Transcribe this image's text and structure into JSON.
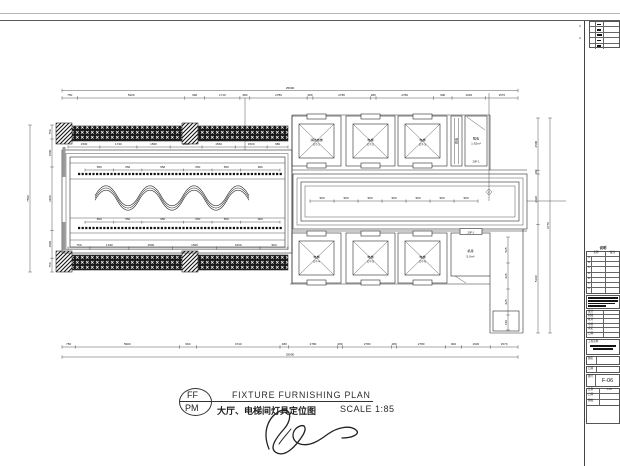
{
  "drawing": {
    "title": "FIXTURE FURNISHING PLAN",
    "subtitle_cn": "大厅、电梯间灯具定位图",
    "scale": "SCALE 1:85",
    "stamp_top": "FF",
    "stamp_bottom": "PM"
  },
  "dims": {
    "overall_top": "25690",
    "overall_bottom": "25690",
    "overall_left": "7560",
    "overall_right": "9770",
    "top": [
      "750",
      "5200",
      "960",
      "1710",
      "480",
      "2780",
      "280",
      "2780",
      "280",
      "2780",
      "900",
      "1630",
      "1570"
    ],
    "bottom": [
      "750",
      "5900",
      "960",
      "4740",
      "480",
      "2780",
      "280",
      "2780",
      "280",
      "2780",
      "900",
      "1630",
      "1570"
    ],
    "left": [
      "750",
      "1500",
      "3400",
      "1500",
      "750"
    ],
    "right": [
      "2500",
      "180",
      "2420",
      "5190"
    ],
    "right_inner": [
      "525",
      "625",
      "625",
      "150"
    ],
    "hall_band": [
      "1500",
      "1740",
      "1560",
      "1500",
      "1560",
      "1500",
      "980"
    ],
    "hall_strip_top": [
      "650",
      "650",
      "950",
      "650",
      "650",
      "900"
    ],
    "hall_strip_bottom": [
      "650",
      "650",
      "950",
      "650",
      "650",
      "900"
    ],
    "hall_bottom": [
      "750",
      "1340",
      "1500",
      "1500",
      "1500",
      "960"
    ],
    "lobby": [
      "950",
      "950",
      "950",
      "950",
      "950",
      "950",
      "950"
    ]
  },
  "rooms": {
    "elev_fire": "消防电梯",
    "elev_fire_no": "DT-1",
    "elev": "电梯",
    "elev2_no": "DT-2",
    "elev3_no": "DT-3",
    "elev4_no": "DT-4",
    "elev5_no": "DT-5",
    "elev6_no": "DT-6",
    "shaft_label": "弱电",
    "room_strong": "强电",
    "room_strong_area": "1.62m²",
    "room_strong_tag": "20F-1",
    "room_machine": "机房",
    "room_machine_area": "5.0m²",
    "room_machine_tag": "20F-1",
    "callout": "2"
  },
  "titleblock": {
    "side_labels": [
      "4",
      "3"
    ],
    "section_label": "说明",
    "col_name": "名称",
    "col_note": "备注",
    "rows": [
      "A",
      "B",
      "C",
      "D",
      "E",
      "F",
      "G"
    ],
    "fields": [
      [
        "设计",
        ""
      ],
      [
        "制图",
        ""
      ],
      [
        "校对",
        ""
      ],
      [
        "审核",
        ""
      ],
      [
        "审定",
        ""
      ],
      [
        "日期",
        ""
      ]
    ],
    "project_label": "工程名称",
    "name_label": "图名",
    "no_label": "图号",
    "drawing_no": "F-06",
    "scale_label": "比例",
    "scale_value": "1:85",
    "date_label": "日期",
    "sheet_label": "图幅"
  }
}
